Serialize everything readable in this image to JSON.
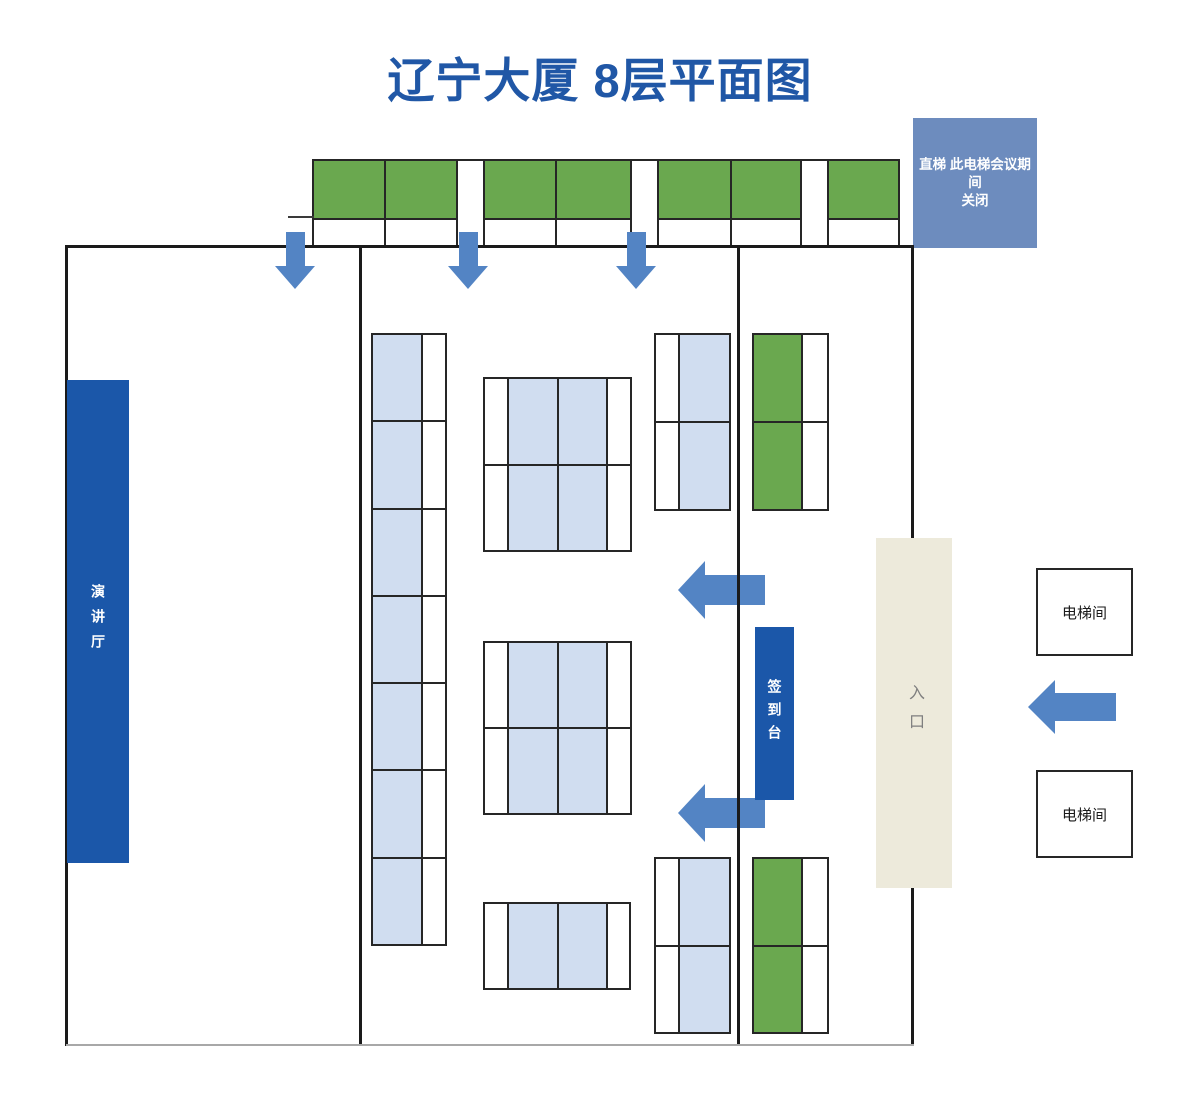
{
  "title": "辽宁大厦 8层平面图",
  "labels": {
    "elevator_note_line1": "直梯 此电梯会议期间",
    "elevator_note_line2": "关闭",
    "lecture_hall": "演讲厅",
    "check_in_desk": "签到台",
    "entrance": "入口",
    "elevator_room": "电梯间"
  },
  "colors": {
    "title_blue": "#2057A6",
    "dark_blue": "#1B57A9",
    "steel_blue": "#6D8CBE",
    "green": "#6AA84F",
    "light_blue": "#D0DDF0",
    "beige": "#EDEADB",
    "arrow_blue": "#5384C4",
    "wall": "#1A1A1A"
  }
}
